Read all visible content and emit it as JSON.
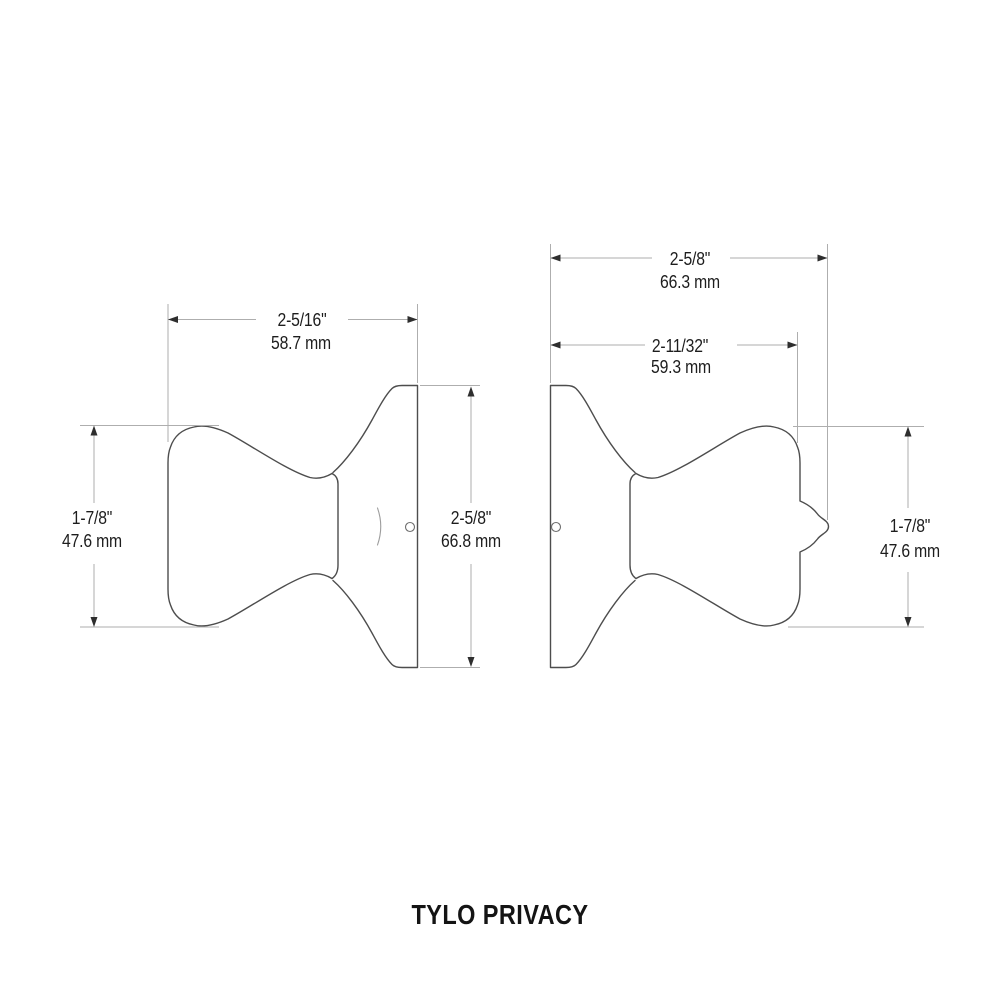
{
  "title": "TYLO PRIVACY",
  "colors": {
    "background": "#ffffff",
    "outline": "#4d4d4d",
    "dimension_lines": "#aeaeae",
    "arrows": "#2e2e2e",
    "text": "#1d1d1d"
  },
  "dimensions": {
    "left_width": {
      "inches": "2-5/16\"",
      "mm": "58.7 mm"
    },
    "left_knob_height": {
      "inches": "1-7/8\"",
      "mm": "47.6 mm"
    },
    "left_rose_height": {
      "inches": "2-5/8\"",
      "mm": "66.8 mm"
    },
    "right_overall_depth": {
      "inches": "2-5/8\"",
      "mm": "66.3 mm"
    },
    "right_knob_depth": {
      "inches": "2-11/32\"",
      "mm": "59.3 mm"
    },
    "right_knob_height": {
      "inches": "1-7/8\"",
      "mm": "47.6 mm"
    }
  }
}
